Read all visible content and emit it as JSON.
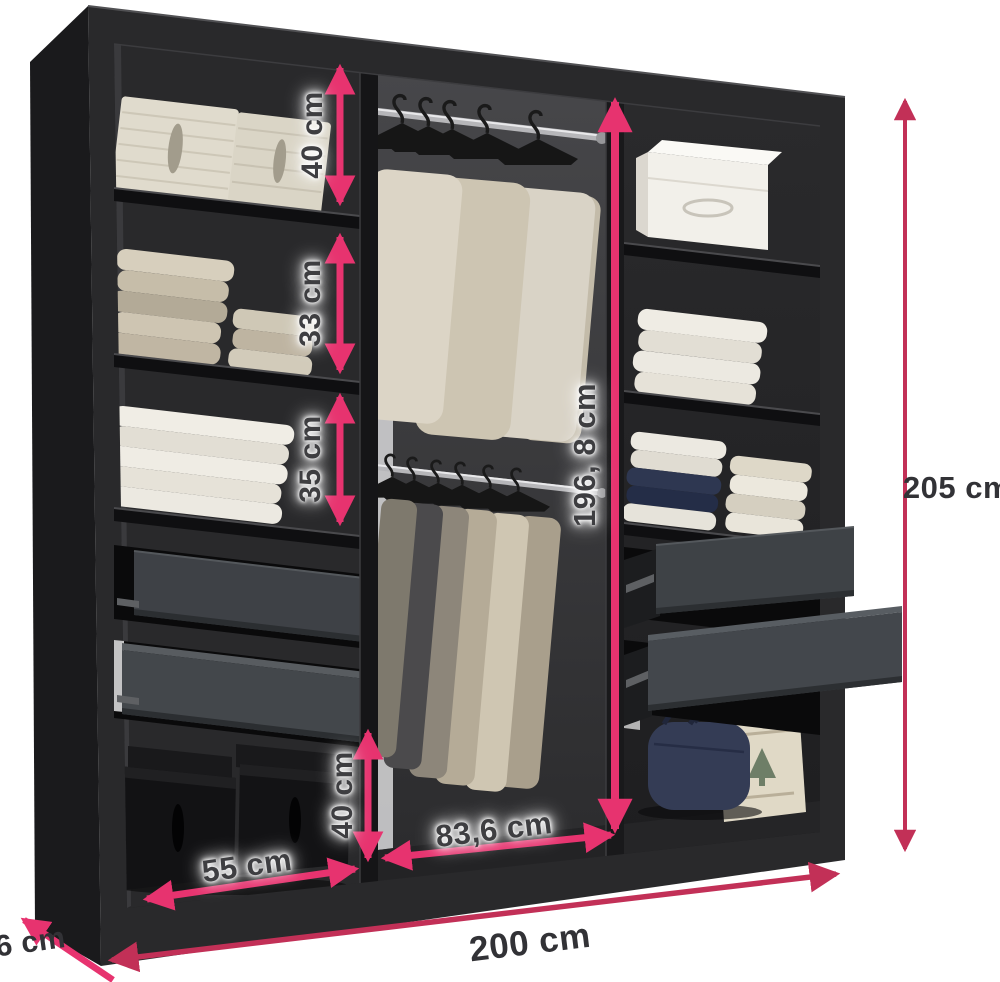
{
  "diagram": {
    "title": "wardrobe-dimensions-diagram",
    "labels": {
      "top_shelf": "40 cm",
      "middle_shelf": "33 cm",
      "lower_shelf": "35 cm",
      "bottom_compartment": "40 cm",
      "hanging_space_height": "196, 8 cm",
      "total_height": "205 cm",
      "left_section_width": "55 cm",
      "middle_section_width": "83,6 cm",
      "total_width": "200 cm",
      "depth": "56 cm"
    },
    "colors": {
      "arrow_pink": "#e7336f",
      "arrow_crimson": "#c23057",
      "cabinet_black": "#29292b",
      "drawer_grey": "#3f4347",
      "background": "#ffffff"
    }
  }
}
